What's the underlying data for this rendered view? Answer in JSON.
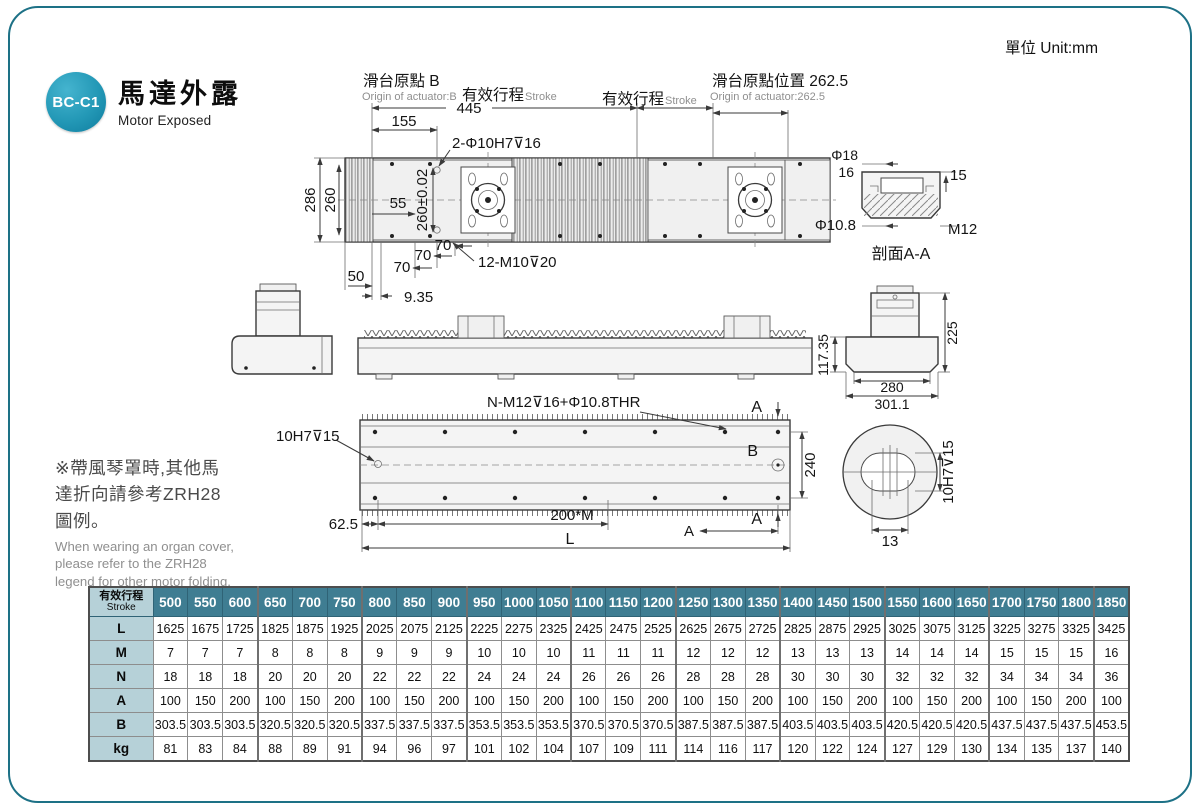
{
  "page": {
    "unit_label": "單位 Unit:mm"
  },
  "header": {
    "badge": "BC-C1",
    "title_zh": "馬達外露",
    "title_en": "Motor Exposed"
  },
  "colors": {
    "accent": "#1d7186",
    "table_header_bg": "#3f7d92",
    "table_label_bg": "#b6d1d8",
    "badge_teal": "#2398b6"
  },
  "note": {
    "zh_lines": [
      "※帶風琴罩時,其他馬",
      "達折向請參考ZRH28",
      "圖例。"
    ],
    "en_lines": [
      "When wearing an organ cover,",
      "please refer to the ZRH28",
      "legend for other motor folding."
    ]
  },
  "drawings": {
    "top_view": {
      "origin_b_zh": "滑台原點 B",
      "origin_b_en": "Origin of actuator:B",
      "stroke1_zh": "有效行程",
      "stroke1_en": "Stroke",
      "stroke2_zh": "有效行程",
      "stroke2_en": "Stroke",
      "origin_pos_zh": "滑台原點位置 262.5",
      "origin_pos_en": "Origin of actuator:262.5",
      "d445": "445",
      "d155": "155",
      "holes": "2-Φ10H7⊽16",
      "d286": "286",
      "d260": "260",
      "d55": "55",
      "d260tol": "260±0.02",
      "d50": "50",
      "d70a": "70",
      "d70b": "70",
      "d70c": "70",
      "d935": "9.35",
      "threads": "12-M10⊽20"
    },
    "section_aa": {
      "phi18": "Φ18",
      "d16": "16",
      "d15": "15",
      "phi108": "Φ10.8",
      "m12": "M12",
      "caption": "剖面A-A"
    },
    "end_view": {
      "d11735": "117.35",
      "d225": "225",
      "d280": "280",
      "d3011": "301.1"
    },
    "bottom_view": {
      "holes": "N-M12⊽16+Φ10.8THR",
      "pin": "10H7⊽15",
      "d625": "62.5",
      "d200m": "200*M",
      "dL": "L",
      "d240": "240",
      "a_top": "A",
      "a_bot": "A",
      "a_dim": "A",
      "b_label": "B"
    },
    "detail_view": {
      "d13": "13",
      "pin": "10H7⊽15"
    }
  },
  "table": {
    "corner_zh": "有效行程",
    "corner_en": "Stroke",
    "strokes": [
      "500",
      "550",
      "600",
      "650",
      "700",
      "750",
      "800",
      "850",
      "900",
      "950",
      "1000",
      "1050",
      "1100",
      "1150",
      "1200",
      "1250",
      "1300",
      "1350",
      "1400",
      "1450",
      "1500",
      "1550",
      "1600",
      "1650",
      "1700",
      "1750",
      "1800",
      "1850"
    ],
    "rows": [
      {
        "label": "L",
        "values": [
          "1625",
          "1675",
          "1725",
          "1825",
          "1875",
          "1925",
          "2025",
          "2075",
          "2125",
          "2225",
          "2275",
          "2325",
          "2425",
          "2475",
          "2525",
          "2625",
          "2675",
          "2725",
          "2825",
          "2875",
          "2925",
          "3025",
          "3075",
          "3125",
          "3225",
          "3275",
          "3325",
          "3425"
        ]
      },
      {
        "label": "M",
        "values": [
          "7",
          "7",
          "7",
          "8",
          "8",
          "8",
          "9",
          "9",
          "9",
          "10",
          "10",
          "10",
          "11",
          "11",
          "11",
          "12",
          "12",
          "12",
          "13",
          "13",
          "13",
          "14",
          "14",
          "14",
          "15",
          "15",
          "15",
          "16"
        ]
      },
      {
        "label": "N",
        "values": [
          "18",
          "18",
          "18",
          "20",
          "20",
          "20",
          "22",
          "22",
          "22",
          "24",
          "24",
          "24",
          "26",
          "26",
          "26",
          "28",
          "28",
          "28",
          "30",
          "30",
          "30",
          "32",
          "32",
          "32",
          "34",
          "34",
          "34",
          "36"
        ]
      },
      {
        "label": "A",
        "values": [
          "100",
          "150",
          "200",
          "100",
          "150",
          "200",
          "100",
          "150",
          "200",
          "100",
          "150",
          "200",
          "100",
          "150",
          "200",
          "100",
          "150",
          "200",
          "100",
          "150",
          "200",
          "100",
          "150",
          "200",
          "100",
          "150",
          "200",
          "100"
        ]
      },
      {
        "label": "B",
        "values": [
          "303.5",
          "303.5",
          "303.5",
          "320.5",
          "320.5",
          "320.5",
          "337.5",
          "337.5",
          "337.5",
          "353.5",
          "353.5",
          "353.5",
          "370.5",
          "370.5",
          "370.5",
          "387.5",
          "387.5",
          "387.5",
          "403.5",
          "403.5",
          "403.5",
          "420.5",
          "420.5",
          "420.5",
          "437.5",
          "437.5",
          "437.5",
          "453.5"
        ]
      },
      {
        "label": "kg",
        "values": [
          "81",
          "83",
          "84",
          "88",
          "89",
          "91",
          "94",
          "96",
          "97",
          "101",
          "102",
          "104",
          "107",
          "109",
          "111",
          "114",
          "116",
          "117",
          "120",
          "122",
          "124",
          "127",
          "129",
          "130",
          "134",
          "135",
          "137",
          "140"
        ]
      }
    ]
  }
}
